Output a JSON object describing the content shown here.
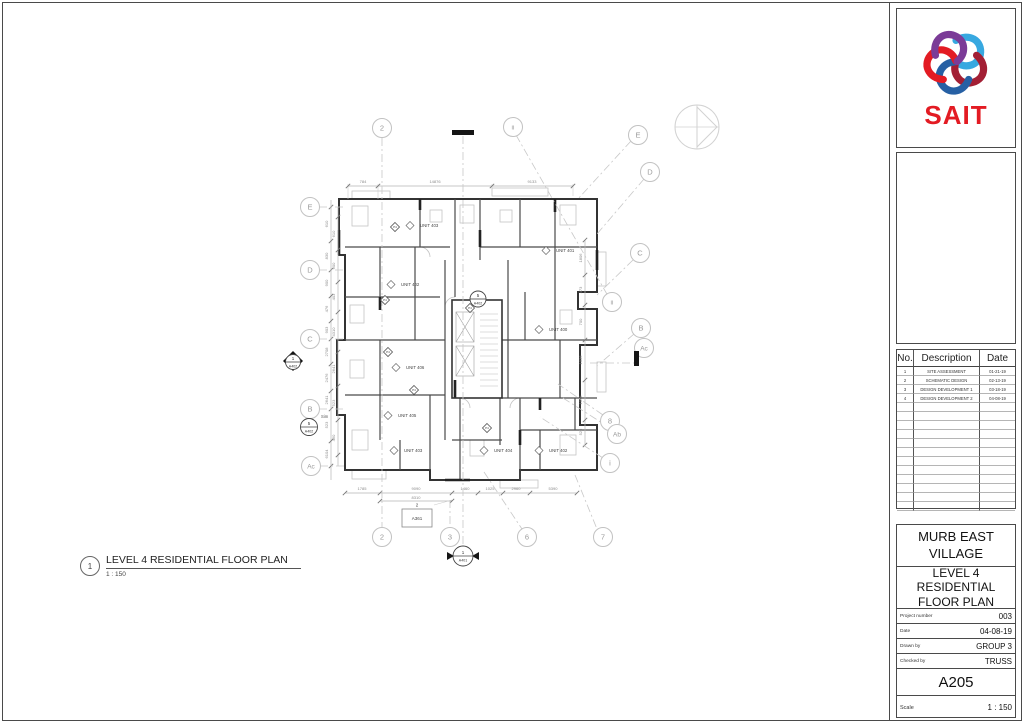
{
  "logo": {
    "brand": "SAIT",
    "brand_color": "#E31B23",
    "knot_colors": [
      "#37A8E0",
      "#A31F34",
      "#2660A4",
      "#E31B23",
      "#7B3B97"
    ]
  },
  "revision_table": {
    "headers": [
      "No.",
      "Description",
      "Date"
    ],
    "rows": [
      [
        "1",
        "SITE ASSESSMENT",
        "01-21-19"
      ],
      [
        "2",
        "SCHEMATIC DESIGN",
        "02-13-19"
      ],
      [
        "3",
        "DESIGN DEVELOPMENT 1",
        "03-18-19"
      ],
      [
        "4",
        "DESIGN DEVELOPMENT 2",
        "04-08-19"
      ]
    ],
    "empty_rows": 12
  },
  "title_block": {
    "project_name": "MURB EAST VILLAGE",
    "sheet_title": "LEVEL 4 RESIDENTIAL FLOOR PLAN",
    "fields": [
      {
        "label": "Project number",
        "value": "003"
      },
      {
        "label": "Date",
        "value": "04-08-19"
      },
      {
        "label": "Drawn by",
        "value": "GROUP 3"
      },
      {
        "label": "Checked by",
        "value": "TRUSS"
      }
    ],
    "sheet_number": "A205",
    "scale_label": "Scale",
    "scale_value": "1 : 150"
  },
  "view_title": {
    "number": "1",
    "title": "LEVEL 4 RESIDENTIAL FLOOR PLAN",
    "scale": "1 : 150"
  },
  "plan": {
    "tag_label": "P4",
    "units": [
      {
        "label": "UNIT 403",
        "x": 420,
        "y": 227
      },
      {
        "label": "UNIT 401",
        "x": 556,
        "y": 252
      },
      {
        "label": "UNIT 402",
        "x": 401,
        "y": 286
      },
      {
        "label": "UNIT 400",
        "x": 549,
        "y": 331
      },
      {
        "label": "UNIT 406",
        "x": 406,
        "y": 369
      },
      {
        "label": "UNIT 405",
        "x": 398,
        "y": 417
      },
      {
        "label": "UNIT 403",
        "x": 404,
        "y": 452
      },
      {
        "label": "UNIT 404",
        "x": 494,
        "y": 452
      },
      {
        "label": "UNIT 402",
        "x": 549,
        "y": 452
      }
    ],
    "tags": [
      {
        "x": 395,
        "y": 227
      },
      {
        "x": 385,
        "y": 300
      },
      {
        "x": 388,
        "y": 352
      },
      {
        "x": 414,
        "y": 390
      },
      {
        "x": 487,
        "y": 428
      },
      {
        "x": 470,
        "y": 308
      }
    ],
    "grid_bubbles": [
      {
        "label": "2",
        "x": 382,
        "y": 128
      },
      {
        "label": "ii",
        "x": 513,
        "y": 127
      },
      {
        "label": "E",
        "x": 638,
        "y": 135
      },
      {
        "label": "D",
        "x": 650,
        "y": 172
      },
      {
        "label": "E",
        "x": 310,
        "y": 207
      },
      {
        "label": "D",
        "x": 310,
        "y": 270
      },
      {
        "label": "C",
        "x": 310,
        "y": 339
      },
      {
        "label": "B",
        "x": 310,
        "y": 409
      },
      {
        "label": "Ac",
        "x": 311,
        "y": 466
      },
      {
        "label": "C",
        "x": 640,
        "y": 253
      },
      {
        "label": "ii",
        "x": 612,
        "y": 302
      },
      {
        "label": "B",
        "x": 641,
        "y": 328
      },
      {
        "label": "Ac",
        "x": 644,
        "y": 348
      },
      {
        "label": "8",
        "x": 610,
        "y": 421
      },
      {
        "label": "Ab",
        "x": 617,
        "y": 434
      },
      {
        "label": "i",
        "x": 610,
        "y": 463
      },
      {
        "label": "2",
        "x": 382,
        "y": 537
      },
      {
        "label": "3",
        "x": 450,
        "y": 537
      },
      {
        "label": "6",
        "x": 527,
        "y": 537
      },
      {
        "label": "7",
        "x": 603,
        "y": 537
      }
    ],
    "leaders": [
      [
        382,
        138,
        382,
        527
      ],
      [
        463,
        136,
        463,
        545
      ],
      [
        450,
        500,
        450,
        527
      ],
      [
        516,
        135,
        608,
        296
      ],
      [
        631,
        141,
        577,
        200
      ],
      [
        644,
        179,
        597,
        234
      ],
      [
        633,
        260,
        597,
        295
      ],
      [
        634,
        334,
        597,
        366
      ],
      [
        590,
        363,
        634,
        363
      ],
      [
        603,
        415,
        558,
        384
      ],
      [
        610,
        428,
        563,
        398
      ],
      [
        603,
        458,
        540,
        417
      ],
      [
        484,
        472,
        522,
        529
      ],
      [
        575,
        475,
        597,
        529
      ],
      [
        319,
        207,
        345,
        207
      ],
      [
        319,
        270,
        345,
        270
      ],
      [
        319,
        339,
        345,
        339
      ],
      [
        319,
        409,
        345,
        409
      ],
      [
        320,
        466,
        345,
        466
      ]
    ],
    "thin_lines": [
      [
        348,
        199,
        348,
        184
      ],
      [
        378,
        199,
        378,
        184
      ],
      [
        492,
        196,
        492,
        184
      ],
      [
        573,
        196,
        573,
        184
      ],
      [
        434,
        505,
        452,
        500
      ]
    ],
    "dim_lines": [
      [
        348,
        186,
        573,
        186
      ],
      [
        345,
        493,
        577,
        493
      ],
      [
        380,
        501,
        452,
        501
      ],
      [
        331,
        200,
        331,
        480
      ],
      [
        338,
        207,
        338,
        466
      ],
      [
        585,
        240,
        585,
        445
      ]
    ],
    "dim_ticks": [
      [
        348,
        186
      ],
      [
        378,
        186
      ],
      [
        492,
        186
      ],
      [
        573,
        186
      ],
      [
        345,
        493
      ],
      [
        380,
        493
      ],
      [
        452,
        493
      ],
      [
        478,
        493
      ],
      [
        503,
        493
      ],
      [
        530,
        493
      ],
      [
        577,
        493
      ],
      [
        380,
        501
      ],
      [
        452,
        501
      ],
      [
        331,
        207
      ],
      [
        331,
        241
      ],
      [
        331,
        270
      ],
      [
        331,
        296
      ],
      [
        331,
        321
      ],
      [
        331,
        339
      ],
      [
        331,
        364
      ],
      [
        331,
        391
      ],
      [
        331,
        409
      ],
      [
        331,
        441
      ],
      [
        331,
        466
      ],
      [
        338,
        217
      ],
      [
        338,
        250
      ],
      [
        338,
        282
      ],
      [
        338,
        312
      ],
      [
        338,
        352
      ],
      [
        338,
        386
      ],
      [
        338,
        420
      ],
      [
        338,
        455
      ],
      [
        585,
        240
      ],
      [
        585,
        275
      ],
      [
        585,
        305
      ],
      [
        585,
        340
      ],
      [
        585,
        380
      ],
      [
        585,
        420
      ],
      [
        585,
        445
      ]
    ],
    "dim_labels": [
      {
        "x": 363,
        "y": 183,
        "t": "784"
      },
      {
        "x": 435,
        "y": 183,
        "t": "14876"
      },
      {
        "x": 532,
        "y": 183,
        "t": "9133"
      },
      {
        "x": 362,
        "y": 490,
        "t": "1785"
      },
      {
        "x": 416,
        "y": 490,
        "t": "9090"
      },
      {
        "x": 465,
        "y": 490,
        "t": "1460"
      },
      {
        "x": 490,
        "y": 490,
        "t": "1025"
      },
      {
        "x": 516,
        "y": 490,
        "t": "2960"
      },
      {
        "x": 553,
        "y": 490,
        "t": "5390"
      },
      {
        "x": 416,
        "y": 499,
        "t": "8310"
      },
      {
        "x": 328,
        "y": 224,
        "t": "610",
        "r": -90
      },
      {
        "x": 328,
        "y": 256,
        "t": "830",
        "r": -90
      },
      {
        "x": 328,
        "y": 283,
        "t": "900",
        "r": -90
      },
      {
        "x": 328,
        "y": 309,
        "t": "476",
        "r": -90
      },
      {
        "x": 328,
        "y": 330,
        "t": "903",
        "r": -90
      },
      {
        "x": 328,
        "y": 352,
        "t": "2708",
        "r": -90
      },
      {
        "x": 328,
        "y": 378,
        "t": "2476",
        "r": -90
      },
      {
        "x": 328,
        "y": 400,
        "t": "2641",
        "r": -90
      },
      {
        "x": 328,
        "y": 425,
        "t": "523",
        "r": -90
      },
      {
        "x": 328,
        "y": 454,
        "t": "6104",
        "r": -90
      },
      {
        "x": 335,
        "y": 234,
        "t": "610",
        "r": -90
      },
      {
        "x": 335,
        "y": 266,
        "t": "900",
        "r": -90
      },
      {
        "x": 335,
        "y": 297,
        "t": "403",
        "r": -90
      },
      {
        "x": 335,
        "y": 332,
        "t": "4310",
        "r": -90
      },
      {
        "x": 335,
        "y": 369,
        "t": "2641",
        "r": -90
      },
      {
        "x": 335,
        "y": 403,
        "t": "523",
        "r": -90
      },
      {
        "x": 335,
        "y": 438,
        "t": "460",
        "r": -90
      },
      {
        "x": 582,
        "y": 258,
        "t": "1806",
        "r": -90
      },
      {
        "x": 582,
        "y": 290,
        "t": "473",
        "r": -90
      },
      {
        "x": 582,
        "y": 322,
        "t": "700",
        "r": -90
      },
      {
        "x": 582,
        "y": 360,
        "t": "1036",
        "r": -90
      },
      {
        "x": 582,
        "y": 400,
        "t": "1076",
        "r": -90
      },
      {
        "x": 582,
        "y": 432,
        "t": "523",
        "r": -90
      }
    ],
    "section_markers": {
      "top_bar": [
        452,
        130,
        22,
        5
      ],
      "right_bar": [
        634,
        351,
        5,
        15
      ],
      "left_arrow": {
        "cx": 293,
        "cy": 361,
        "top": "1",
        "bottom": "A402"
      },
      "bottom_circle": {
        "cx": 463,
        "cy": 556,
        "top": "1",
        "bottom": "A401"
      },
      "sim_circle": {
        "cx": 309,
        "cy": 427,
        "top": "5",
        "bottom": "A402",
        "note": "Sim"
      },
      "core_circle": {
        "cx": 478,
        "cy": 299,
        "top": "5",
        "bottom": "A402"
      }
    },
    "callout": {
      "x": 402,
      "y": 509,
      "w": 30,
      "h": 18,
      "label": "A361",
      "num": "2"
    },
    "north_arrow": {
      "cx": 697,
      "cy": 127,
      "r": 22
    }
  }
}
